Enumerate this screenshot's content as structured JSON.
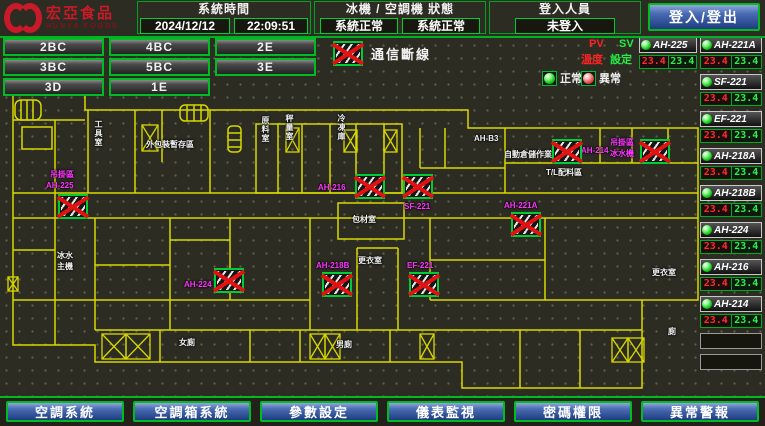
{
  "header": {
    "brand": {
      "name": "宏亞食品",
      "name_en": "HUNYA FOODS"
    },
    "system_time": {
      "label": "系統時間",
      "date": "2024/12/12",
      "time": "22:09:51"
    },
    "status": {
      "label": "冰機 / 空調機 狀態",
      "chiller": "系統正常",
      "ahu": "系統正常"
    },
    "login": {
      "label": "登入人員",
      "user": "未登入",
      "button": "登入/登出"
    }
  },
  "floor_buttons": [
    "2BC",
    "4BC",
    "2E",
    "3BC",
    "5BC",
    "3E",
    "3D",
    "1E"
  ],
  "legend": {
    "comm_fail": "通信斷線",
    "normal": "正常",
    "abnormal": "異常",
    "pv": "PV",
    "sv": "SV",
    "pv_caption": "溫度",
    "sv_caption": "設定"
  },
  "equipment": {
    "units": [
      {
        "name": "AH-225",
        "pv": "23.4",
        "sv": "23.4"
      },
      {
        "name": "AH-221A",
        "pv": "23.4",
        "sv": "23.4"
      },
      {
        "name": "SF-221",
        "pv": "23.4",
        "sv": "23.4"
      },
      {
        "name": "EF-221",
        "pv": "23.4",
        "sv": "23.4"
      },
      {
        "name": "AH-218A",
        "pv": "23.4",
        "sv": "23.4"
      },
      {
        "name": "AH-218B",
        "pv": "23.4",
        "sv": "23.4"
      },
      {
        "name": "AH-224",
        "pv": "23.4",
        "sv": "23.4"
      },
      {
        "name": "AH-216",
        "pv": "23.4",
        "sv": "23.4"
      },
      {
        "name": "AH-214",
        "pv": "23.4",
        "sv": "23.4"
      }
    ],
    "empty_slots": 2
  },
  "floorplan": {
    "device_fault_icons": [
      {
        "x": 58,
        "y": 194
      },
      {
        "x": 214,
        "y": 268
      },
      {
        "x": 355,
        "y": 174
      },
      {
        "x": 403,
        "y": 174
      },
      {
        "x": 511,
        "y": 212
      },
      {
        "x": 322,
        "y": 272
      },
      {
        "x": 409,
        "y": 272
      },
      {
        "x": 552,
        "y": 139
      },
      {
        "x": 640,
        "y": 139
      }
    ],
    "labels": [
      {
        "text": "吊掛區",
        "x": 50,
        "y": 170,
        "color": "magenta"
      },
      {
        "text": "AH-225",
        "x": 46,
        "y": 181,
        "color": "magenta"
      },
      {
        "text": "AH-224",
        "x": 184,
        "y": 280,
        "color": "magenta"
      },
      {
        "text": "AH-216",
        "x": 318,
        "y": 183,
        "color": "magenta"
      },
      {
        "text": "SF-221",
        "x": 404,
        "y": 202,
        "color": "magenta"
      },
      {
        "text": "AH-221A",
        "x": 504,
        "y": 201,
        "color": "magenta"
      },
      {
        "text": "AH-218B",
        "x": 316,
        "y": 261,
        "color": "magenta"
      },
      {
        "text": "EF-221",
        "x": 407,
        "y": 261,
        "color": "magenta"
      },
      {
        "text": "AH-214",
        "x": 581,
        "y": 146,
        "color": "magenta"
      },
      {
        "text": "吊掛區",
        "x": 610,
        "y": 138,
        "color": "magenta"
      },
      {
        "text": "冰水機",
        "x": 610,
        "y": 149,
        "color": "magenta"
      },
      {
        "text": "工具室",
        "x": 94,
        "y": 120,
        "color": "white",
        "vertical": true
      },
      {
        "text": "外包裝暫存區",
        "x": 146,
        "y": 140,
        "color": "white"
      },
      {
        "text": "原料室",
        "x": 261,
        "y": 116,
        "color": "white",
        "vertical": true
      },
      {
        "text": "秤量室",
        "x": 285,
        "y": 114,
        "color": "white",
        "vertical": true
      },
      {
        "text": "冷凍庫",
        "x": 337,
        "y": 114,
        "color": "white",
        "vertical": true
      },
      {
        "text": "AH-B3",
        "x": 474,
        "y": 134,
        "color": "white"
      },
      {
        "text": "自動倉儲作業區",
        "x": 504,
        "y": 150,
        "color": "white"
      },
      {
        "text": "T/L配料區",
        "x": 546,
        "y": 168,
        "color": "white"
      },
      {
        "text": "包材室",
        "x": 352,
        "y": 215,
        "color": "white"
      },
      {
        "text": "更衣室",
        "x": 358,
        "y": 256,
        "color": "white"
      },
      {
        "text": "冰水",
        "x": 57,
        "y": 251,
        "color": "white"
      },
      {
        "text": "主機",
        "x": 57,
        "y": 262,
        "color": "white"
      },
      {
        "text": "女廁",
        "x": 179,
        "y": 338,
        "color": "white"
      },
      {
        "text": "男廁",
        "x": 336,
        "y": 340,
        "color": "white"
      },
      {
        "text": "更衣室",
        "x": 652,
        "y": 268,
        "color": "white"
      },
      {
        "text": "廁",
        "x": 668,
        "y": 327,
        "color": "white"
      }
    ]
  },
  "bottom_buttons": [
    "空調系統",
    "空調箱系統",
    "參數設定",
    "儀表監視",
    "密碼權限",
    "異常警報"
  ],
  "colors": {
    "accent_green": "#00bb22",
    "wall_yellow": "#d8d800",
    "label_magenta": "#ff33ff",
    "alarm_red": "#e31212",
    "button_blue": "#3a5fae"
  }
}
